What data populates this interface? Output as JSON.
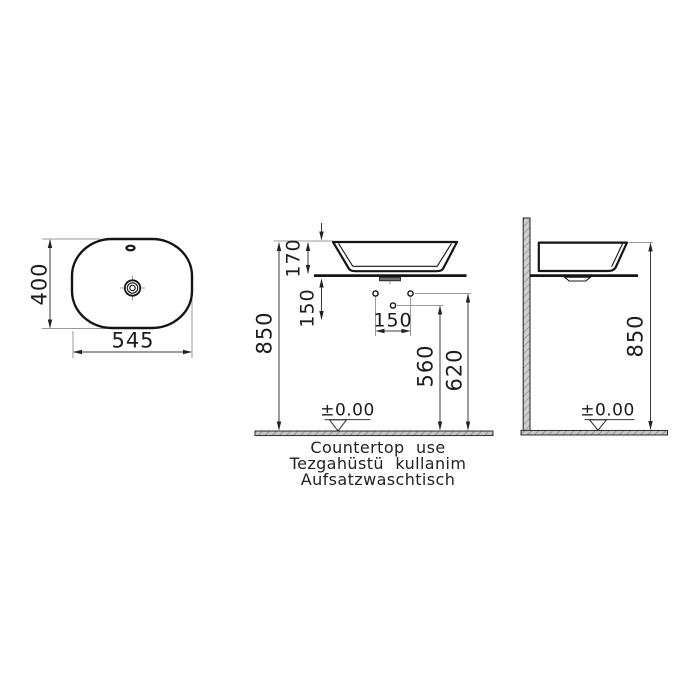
{
  "plan_view": {
    "width_mm": "545",
    "depth_mm": "400"
  },
  "front_view": {
    "basin_height_mm": "170",
    "overall_height_mm": "850",
    "counter_to_holes_mm": "150",
    "hole_spacing_mm": "150",
    "drain_outlet_height_mm": "560",
    "supply_holes_height_mm": "620",
    "floor_datum": "±0.00"
  },
  "side_view": {
    "overall_height_mm": "850",
    "floor_datum": "±0.00"
  },
  "caption": {
    "en": "Countertop use",
    "tr": "Tezgahüstü kullanim",
    "de": "Aufsatzwaschtisch"
  }
}
